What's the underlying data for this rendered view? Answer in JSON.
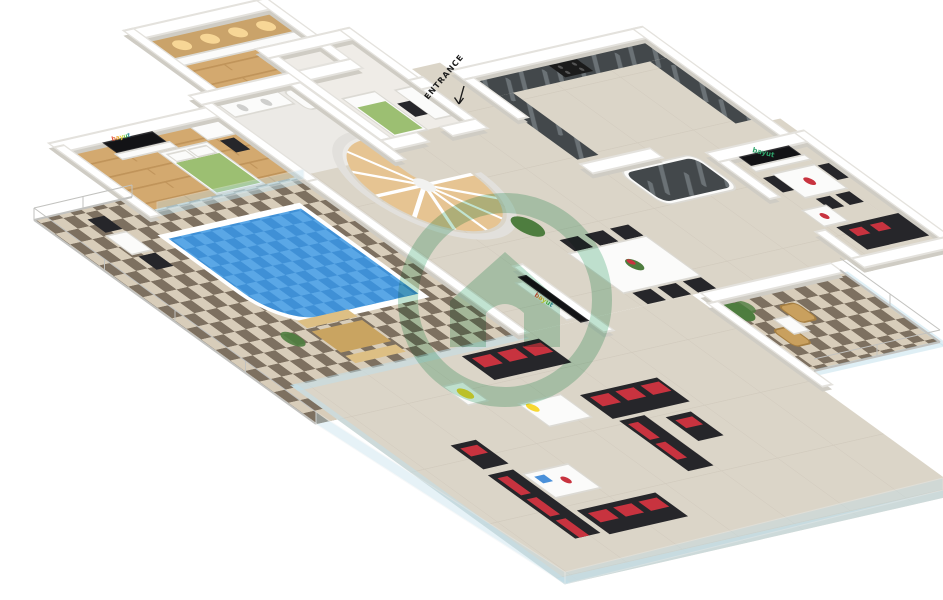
{
  "labels": {
    "entrance": "ENTRANCE"
  },
  "branding": {
    "tv_logo_text": "bayut"
  },
  "watermark": {
    "icon": "house-in-circle",
    "color": "#5cb585",
    "opacity": 0.38
  },
  "colors": {
    "tileDark": "#7d7060",
    "tileLight": "#d8cdba",
    "floorBeige": "#dbd5c8",
    "woodFloor": "#d3a96f",
    "woodLine": "#c0945a",
    "poolBlue": "#3f90d6",
    "poolLight": "#5aa7e6",
    "counterDark": "#43484b",
    "counterVein": "#6b7276",
    "sofaBlack": "#26262a",
    "cushionRed": "#c8333f",
    "bedGreen": "#9cbf72",
    "lampYellow": "#f7d832",
    "stairWood": "#e6c492",
    "glassBlue": "#bfdfec",
    "railGray": "#c2c2bf",
    "benchWood": "#c9a461",
    "benchWoodLight": "#ddbf84",
    "wicker": "#c9a05e",
    "plantGreen": "#4e7d3f",
    "wallWhite": "#ffffff",
    "wallShadow": "#cfccc4",
    "brandGreen": "#2fa36b",
    "watermarkGreen": "#5cb585",
    "textDark": "#1c1c1c"
  }
}
